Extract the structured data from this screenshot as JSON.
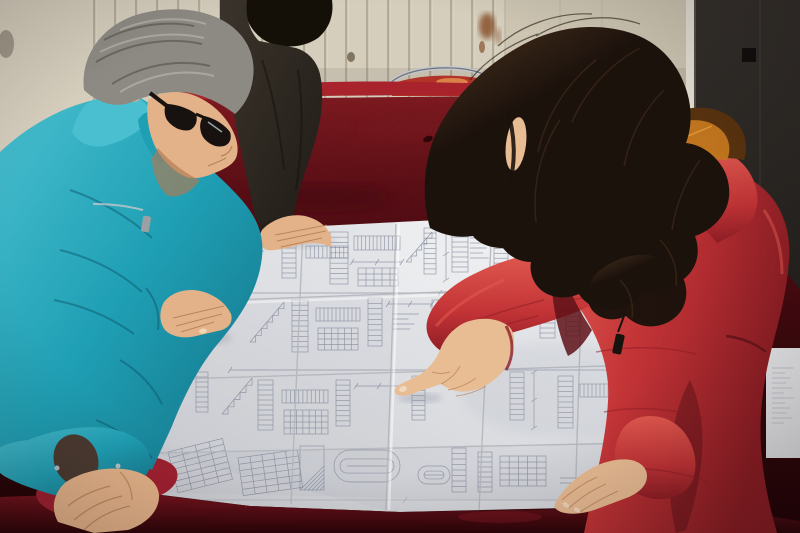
{
  "scene": {
    "description": "Photograph: a gray-haired man in a teal work jacket and a woman in a red fur-trimmed parka lean over a large folded engineering blueprint spread on a crimson velvet-covered table; a third person in a dark jacket rests a hand on the drawing; background shows a ribbed cream wall panel with rust stains and a dark door.",
    "people": [
      {
        "id": "man-worker",
        "label": "man in teal jacket with glasses"
      },
      {
        "id": "person-dark-jacket",
        "label": "person in dark jacket (hand on drawing)"
      },
      {
        "id": "woman-red-coat",
        "label": "woman in red parka pointing at blueprint"
      }
    ],
    "objects": [
      "blueprint",
      "velvet-covered table",
      "chair rim",
      "ribbed wall panel",
      "dark door"
    ]
  },
  "palette": {
    "wallLight": "#d5cebd",
    "wallGroove": "#968d7a",
    "wallGrooveHi": "#e6e0d2",
    "panel": "#cdc5b2",
    "panelLine": "#b3ab99",
    "brightFrame": "#e4e0d4",
    "doorTop": "#33302c",
    "doorBottom": "#171411",
    "doorEdge": "#5c5750",
    "doorHandle": "#0d0b09",
    "rust": "#7c4018",
    "knot": "#4a3a20",
    "metal": "#c3c7cc",
    "metalDark": "#6f737a",
    "chairRed": "#b23328",
    "chairHi": "#e08a4e",
    "velvetBright": "#a8232b",
    "velvetMid": "#77131d",
    "velvetDark": "#4a0a10",
    "velvetDeep": "#2a0408",
    "foldRed": "#9e2030",
    "foldHi": "#c14a50",
    "paperLight": "#f0f1f3",
    "paperMid": "#dcdee2",
    "paperShadow": "#c6c8cd",
    "ink": "#7b8294",
    "crease": "#b2b4ba",
    "tealLight": "#49bfd0",
    "teal": "#1f9fb4",
    "tealDark": "#137085",
    "tealDeep": "#0b5266",
    "innerSleeve": "#4a3a30",
    "skin": "#e3b289",
    "skinShadow": "#b17a52",
    "skinW": "#e9bd94",
    "skinShadowW": "#bd8458",
    "nail": "#f2d9c0",
    "hairGray": "#8d8a84",
    "hairGrayLight": "#c2bfb9",
    "hairGrayDark": "#504b44",
    "glasses": "#17120f",
    "darkHair": "#141007",
    "darkJacket": "#3b342c",
    "darkJacketDeep": "#201c16",
    "womanHair": "#1c120c",
    "womanHairLight": "#4b331f",
    "coatRed": "#c23336",
    "coatRedLight": "#e25a50",
    "coatRedDark": "#8c1d24",
    "coatRedDeep": "#5e1218",
    "fur": "#c97a20",
    "furLight": "#e8a83f",
    "furDark": "#59330f",
    "zipper": "#17130f"
  },
  "blueprint": {
    "figures": [
      {
        "t": "scrib",
        "x": 250,
        "y": 246,
        "w": 26,
        "h": 12
      },
      {
        "t": "ladder",
        "x": 282,
        "y": 238,
        "w": 14,
        "h": 40,
        "n": 8
      },
      {
        "t": "hladder",
        "x": 306,
        "y": 246,
        "w": 42,
        "h": 12,
        "n": 10
      },
      {
        "t": "ladder",
        "x": 330,
        "y": 232,
        "w": 18,
        "h": 52,
        "n": 10
      },
      {
        "t": "hladder",
        "x": 354,
        "y": 236,
        "w": 46,
        "h": 14,
        "n": 12
      },
      {
        "t": "dim",
        "x": 352,
        "y": 262,
        "w": 50
      },
      {
        "t": "grid",
        "x": 358,
        "y": 268,
        "w": 40,
        "h": 18,
        "rw": 3,
        "cl": 5
      },
      {
        "t": "steps",
        "x": 406,
        "y": 232,
        "w": 26,
        "h": 30,
        "n": 5
      },
      {
        "t": "ladder",
        "x": 424,
        "y": 228,
        "w": 12,
        "h": 46,
        "n": 9
      },
      {
        "t": "vdim",
        "x": 446,
        "y": 228,
        "h": 52
      },
      {
        "t": "ladder",
        "x": 452,
        "y": 232,
        "w": 16,
        "h": 40,
        "n": 8
      },
      {
        "t": "scrib",
        "x": 470,
        "y": 238,
        "w": 22,
        "h": 26
      },
      {
        "t": "ladder",
        "x": 494,
        "y": 224,
        "w": 14,
        "h": 44,
        "n": 9
      },
      {
        "t": "hladder",
        "x": 560,
        "y": 224,
        "w": 40,
        "h": 12,
        "n": 10
      },
      {
        "t": "ladder",
        "x": 608,
        "y": 220,
        "w": 14,
        "h": 40,
        "n": 8
      },
      {
        "t": "dim",
        "x": 250,
        "y": 293,
        "w": 380
      },
      {
        "t": "steps",
        "x": 250,
        "y": 302,
        "w": 34,
        "h": 40,
        "n": 6
      },
      {
        "t": "ladder",
        "x": 292,
        "y": 300,
        "w": 16,
        "h": 52,
        "n": 10
      },
      {
        "t": "hladder",
        "x": 316,
        "y": 308,
        "w": 44,
        "h": 13,
        "n": 11
      },
      {
        "t": "grid",
        "x": 318,
        "y": 328,
        "w": 40,
        "h": 22,
        "rw": 4,
        "cl": 6
      },
      {
        "t": "ladder",
        "x": 368,
        "y": 298,
        "w": 14,
        "h": 48,
        "n": 9
      },
      {
        "t": "dim",
        "x": 388,
        "y": 304,
        "w": 44
      },
      {
        "t": "scrib",
        "x": 392,
        "y": 314,
        "w": 30,
        "h": 20
      },
      {
        "t": "hatch",
        "x": 432,
        "y": 300,
        "w": 26,
        "h": 40
      },
      {
        "t": "ladder",
        "x": 466,
        "y": 296,
        "w": 14,
        "h": 46,
        "n": 9
      },
      {
        "t": "vdim",
        "x": 490,
        "y": 294,
        "h": 54
      },
      {
        "t": "ladder",
        "x": 540,
        "y": 288,
        "w": 15,
        "h": 50,
        "n": 10
      },
      {
        "t": "ladder",
        "x": 566,
        "y": 292,
        "w": 13,
        "h": 44,
        "n": 9
      },
      {
        "t": "hladder",
        "x": 590,
        "y": 302,
        "w": 40,
        "h": 12,
        "n": 10
      },
      {
        "t": "dim",
        "x": 230,
        "y": 370,
        "w": 420
      },
      {
        "t": "steps",
        "x": 222,
        "y": 378,
        "w": 30,
        "h": 36,
        "n": 5
      },
      {
        "t": "ladder",
        "x": 258,
        "y": 380,
        "w": 15,
        "h": 50,
        "n": 10
      },
      {
        "t": "hladder",
        "x": 282,
        "y": 390,
        "w": 46,
        "h": 13,
        "n": 11
      },
      {
        "t": "grid",
        "x": 284,
        "y": 410,
        "w": 44,
        "h": 24,
        "rw": 4,
        "cl": 7
      },
      {
        "t": "ladder",
        "x": 336,
        "y": 380,
        "w": 14,
        "h": 46,
        "n": 9
      },
      {
        "t": "dim",
        "x": 356,
        "y": 386,
        "w": 46
      },
      {
        "t": "ladder",
        "x": 412,
        "y": 376,
        "w": 13,
        "h": 44,
        "n": 9
      },
      {
        "t": "ladder",
        "x": 510,
        "y": 372,
        "w": 14,
        "h": 48,
        "n": 9
      },
      {
        "t": "vdim",
        "x": 534,
        "y": 372,
        "h": 56
      },
      {
        "t": "ladder",
        "x": 558,
        "y": 376,
        "w": 15,
        "h": 52,
        "n": 10
      },
      {
        "t": "hladder",
        "x": 580,
        "y": 384,
        "w": 44,
        "h": 13,
        "n": 11
      },
      {
        "t": "grid",
        "x": 168,
        "y": 452,
        "w": 56,
        "h": 42,
        "rw": 7,
        "cl": 4,
        "rot": -14
      },
      {
        "t": "grid",
        "x": 238,
        "y": 458,
        "w": 60,
        "h": 38,
        "rw": 6,
        "cl": 5,
        "rot": -8
      },
      {
        "t": "hatch",
        "x": 300,
        "y": 446,
        "w": 24,
        "h": 44
      },
      {
        "t": "oval",
        "x": 334,
        "y": 450,
        "w": 66,
        "h": 32
      },
      {
        "t": "oval",
        "x": 418,
        "y": 466,
        "w": 32,
        "h": 18
      },
      {
        "t": "ladder",
        "x": 452,
        "y": 448,
        "w": 14,
        "h": 44,
        "n": 8
      },
      {
        "t": "ladder",
        "x": 478,
        "y": 452,
        "w": 14,
        "h": 40,
        "n": 8
      },
      {
        "t": "grid",
        "x": 500,
        "y": 456,
        "w": 46,
        "h": 30,
        "rw": 5,
        "cl": 5
      },
      {
        "t": "scrib",
        "x": 560,
        "y": 478,
        "w": 36,
        "h": 14
      },
      {
        "t": "vdim",
        "x": 622,
        "y": 430,
        "h": 60
      },
      {
        "t": "ladder",
        "x": 604,
        "y": 440,
        "w": 13,
        "h": 50,
        "n": 10
      },
      {
        "t": "scrib",
        "x": 180,
        "y": 330,
        "w": 20,
        "h": 30
      },
      {
        "t": "ladder",
        "x": 196,
        "y": 372,
        "w": 12,
        "h": 40,
        "n": 8
      },
      {
        "t": "dim",
        "x": 175,
        "y": 500,
        "w": 460,
        "o": 0.4
      },
      {
        "t": "scrib",
        "x": 772,
        "y": 368,
        "w": 24,
        "h": 60,
        "o": 0.45
      }
    ]
  }
}
